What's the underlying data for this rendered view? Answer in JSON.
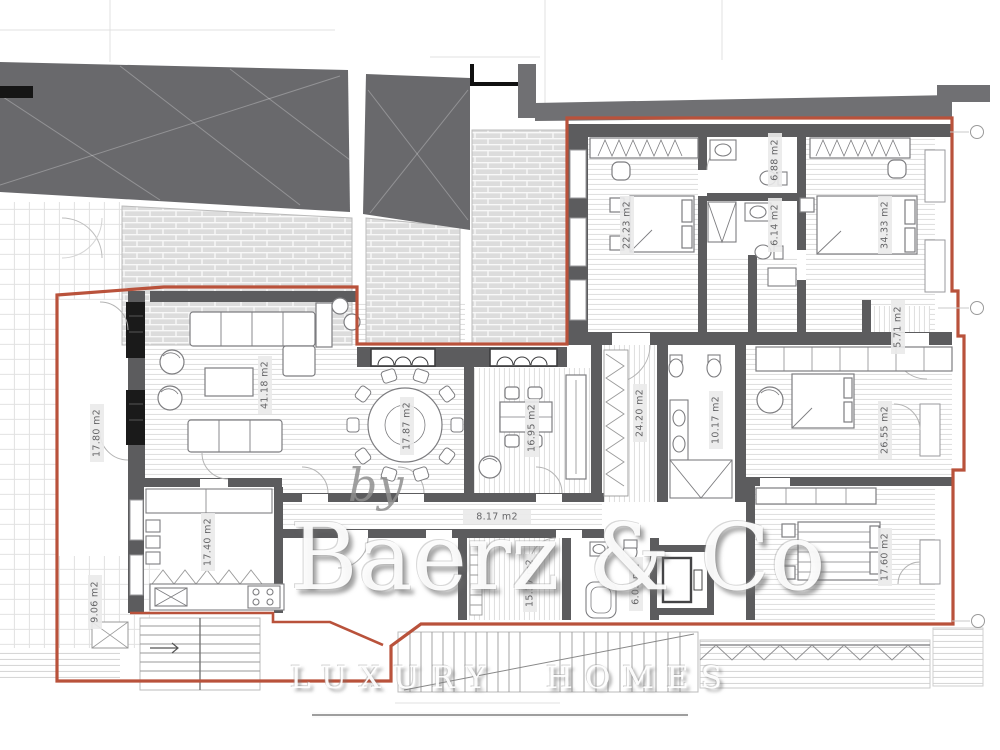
{
  "drawing": {
    "type": "apartment-floor-plan",
    "units": "m2"
  },
  "colors": {
    "boundary_red": "#b9523b",
    "roof_dark": "#69696c",
    "wall_gray": "#5c5c5e",
    "brick_fill": "#dcdcdc",
    "label_text": "#666668"
  },
  "watermark": {
    "by": "by",
    "brand": "Baerz & Co",
    "tagline": "LUXURY HOMES"
  },
  "rooms": {
    "terrace_main": {
      "name": "terrace",
      "area": "17.80 m2"
    },
    "terrace_lower": {
      "name": "terrace",
      "area": "9.06 m2"
    },
    "living": {
      "name": "living room",
      "area": "41.18 m2"
    },
    "dining": {
      "name": "dining room",
      "area": "17.87 m2"
    },
    "study": {
      "name": "study",
      "area": "16.95 m2"
    },
    "kitchen": {
      "name": "kitchen",
      "area": "17.40 m2"
    },
    "hallway": {
      "name": "hallway",
      "area": "8.17 m2"
    },
    "dressing": {
      "name": "dressing",
      "area": "15.37 m2"
    },
    "bath_small": {
      "name": "bathroom",
      "area": "6.05 m2"
    },
    "corridor": {
      "name": "corridor",
      "area": "24.20 m2"
    },
    "bath_master": {
      "name": "bathroom",
      "area": "10.17 m2"
    },
    "bedroom_c": {
      "name": "bedroom",
      "area": "26.55 m2"
    },
    "bedroom_d": {
      "name": "bedroom",
      "area": "17.60 m2"
    },
    "bedroom_a": {
      "name": "bedroom",
      "area": "22.23 m2"
    },
    "bath_a": {
      "name": "bathroom",
      "area": "6.88 m2"
    },
    "bath_b": {
      "name": "bathroom",
      "area": "6.14 m2"
    },
    "bedroom_b": {
      "name": "bedroom",
      "area": "34.33 m2"
    },
    "corridor_small": {
      "name": "corridor",
      "area": "5.71 m2"
    }
  }
}
